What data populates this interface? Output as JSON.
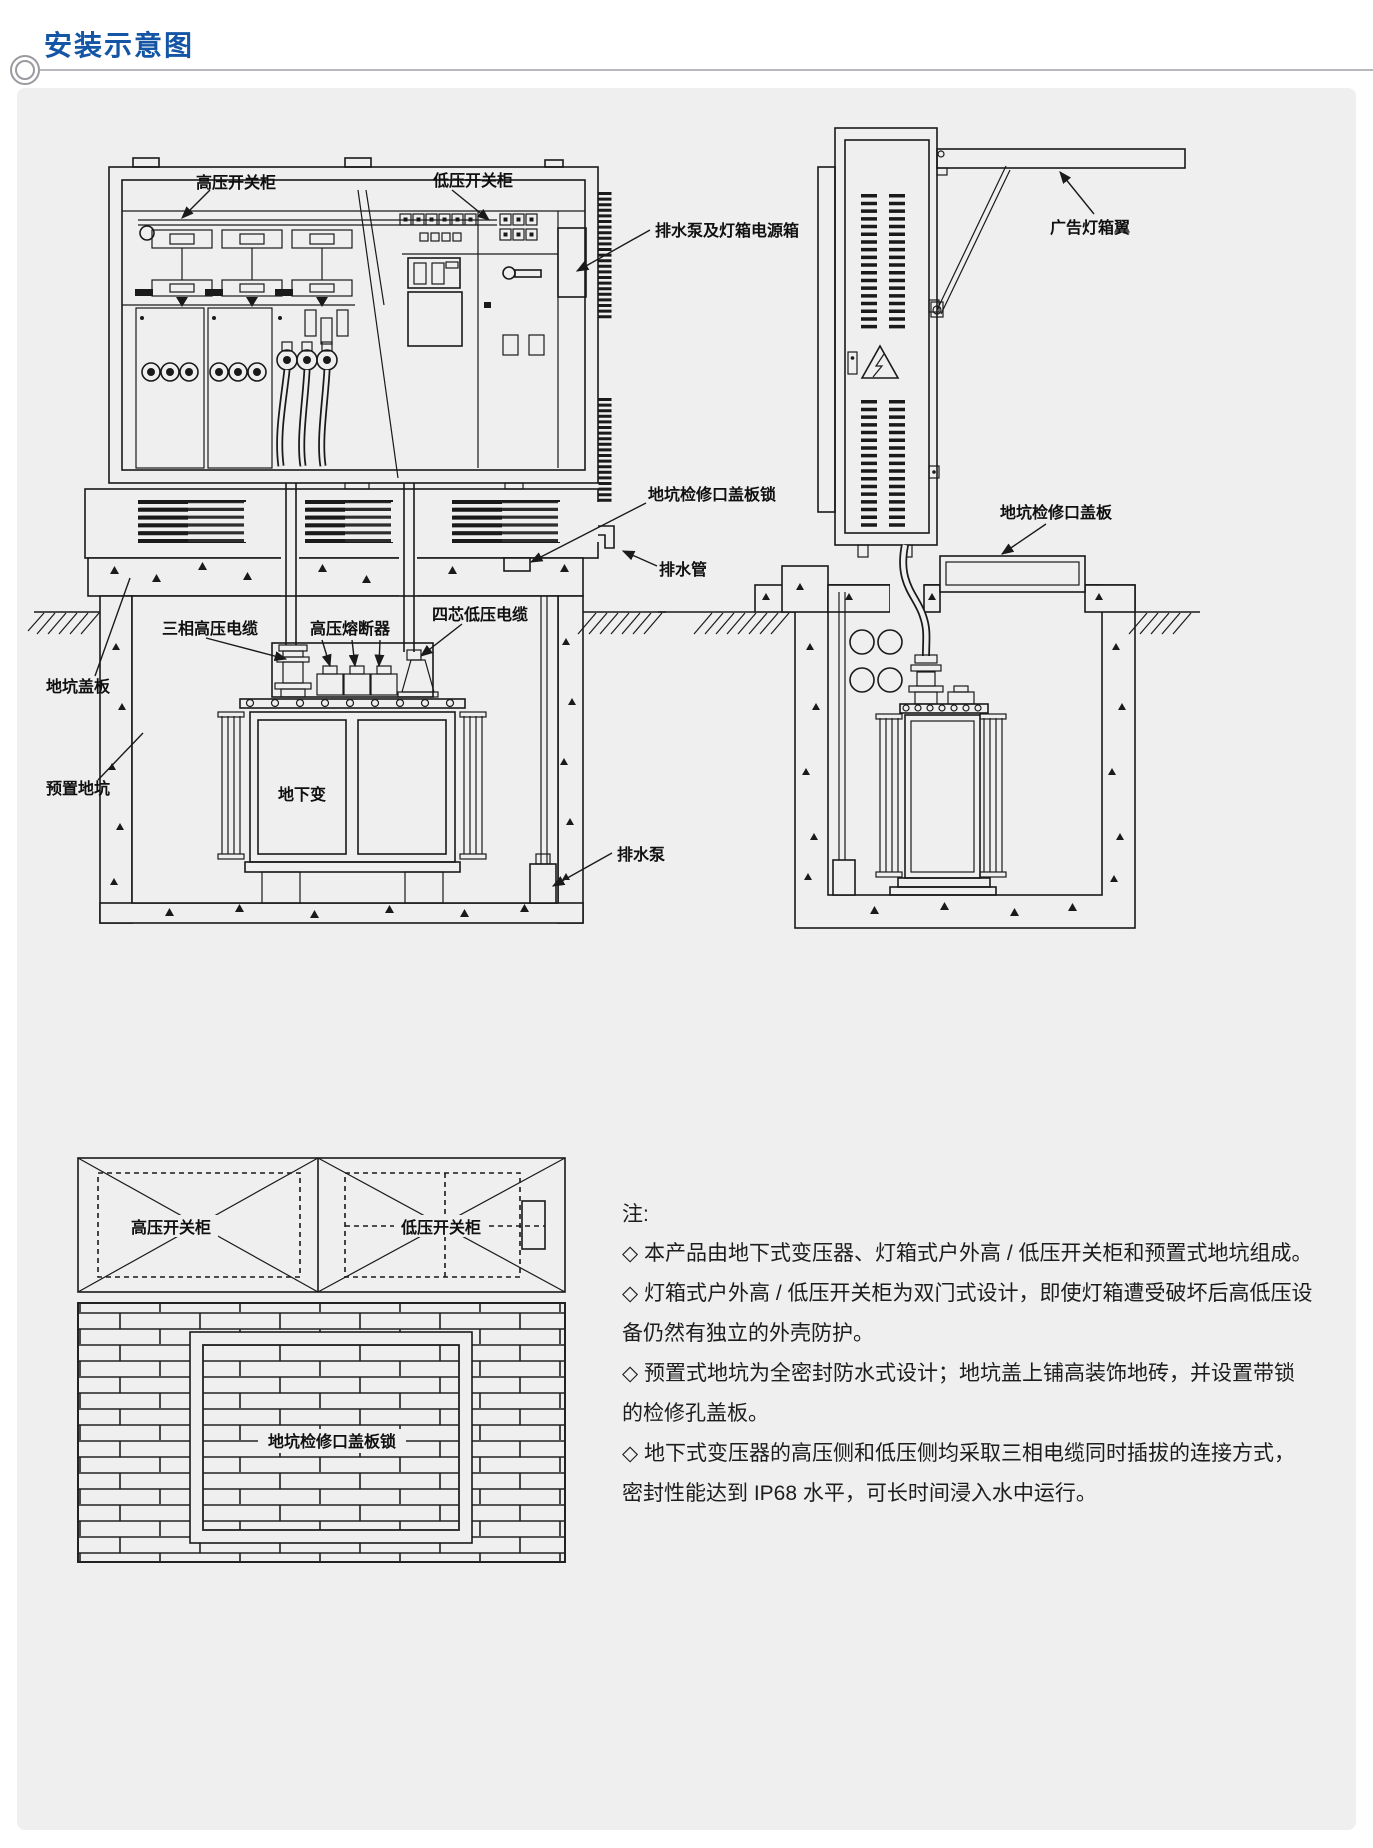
{
  "header": {
    "title": "安装示意图"
  },
  "colors": {
    "accent": "#1456a5",
    "panel": "#efeff0",
    "line": "#1a1a1a"
  },
  "front_view": {
    "labels": {
      "hv_cabinet": "高压开关柜",
      "lv_cabinet": "低压开关柜",
      "pump_power_box": "排水泵及灯箱电源箱",
      "pit_access_cover_lock": "地坑检修口盖板锁",
      "drain_pipe": "排水管",
      "pit_cover": "地坑盖板",
      "precast_pit": "预置地坑",
      "three_phase_hv_cable": "三相高压电缆",
      "hv_fuse": "高压熔断器",
      "four_core_lv_cable": "四芯低压电缆",
      "underground_transformer": "地下变",
      "drain_pump": "排水泵"
    }
  },
  "side_view": {
    "labels": {
      "ad_lightbox_wing": "广告灯箱翼",
      "pit_access_cover": "地坑检修口盖板"
    }
  },
  "plan_view": {
    "labels": {
      "hv_cabinet": "高压开关柜",
      "lv_cabinet": "低压开关柜",
      "pit_access_cover_lock": "地坑检修口盖板锁"
    }
  },
  "notes": {
    "heading": "注:",
    "items": [
      "◇ 本产品由地下式变压器、灯箱式户外高 / 低压开关柜和预置式地坑组成。",
      "◇ 灯箱式户外高 / 低压开关柜为双门式设计，即使灯箱遭受破坏后高低压设备仍然有独立的外壳防护。",
      "◇ 预置式地坑为全密封防水式设计；地坑盖上铺高装饰地砖，并设置带锁的检修孔盖板。",
      "◇ 地下式变压器的高压侧和低压侧均采取三相电缆同时插拔的连接方式，密封性能达到 IP68 水平，可长时间浸入水中运行。"
    ]
  }
}
